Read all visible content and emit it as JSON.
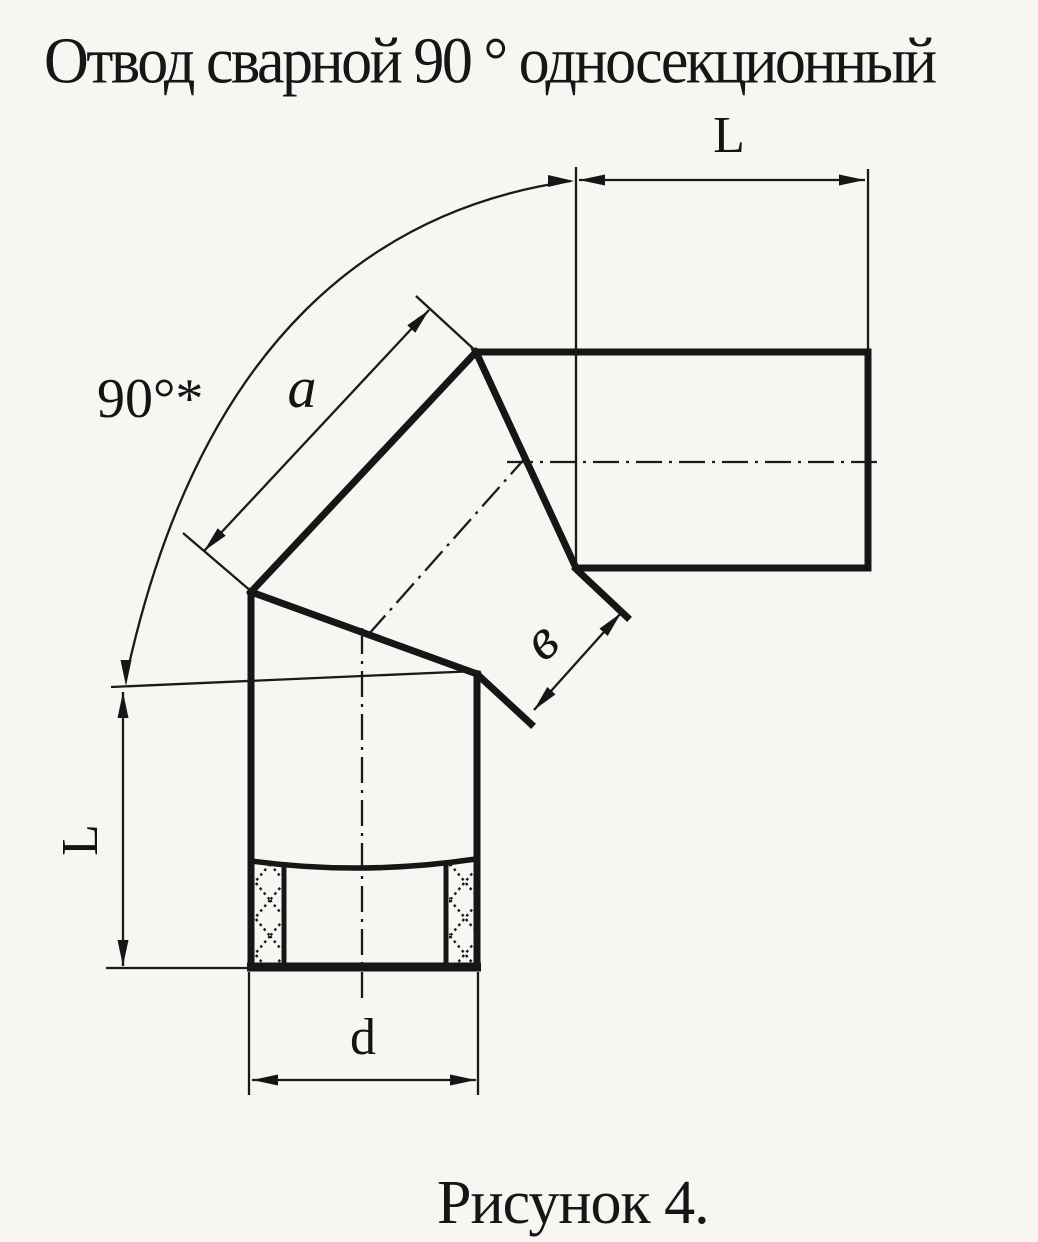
{
  "title": "Отвод сварной 90 ° односекционный",
  "caption": "Рисунок 4.",
  "labels": {
    "angle": "90°*",
    "top_length": "L",
    "left_length": "L",
    "section_a": "a",
    "section_b": "в",
    "diameter": "d"
  },
  "colors": {
    "ink": "#161616",
    "paper": "#f7f6f2"
  }
}
